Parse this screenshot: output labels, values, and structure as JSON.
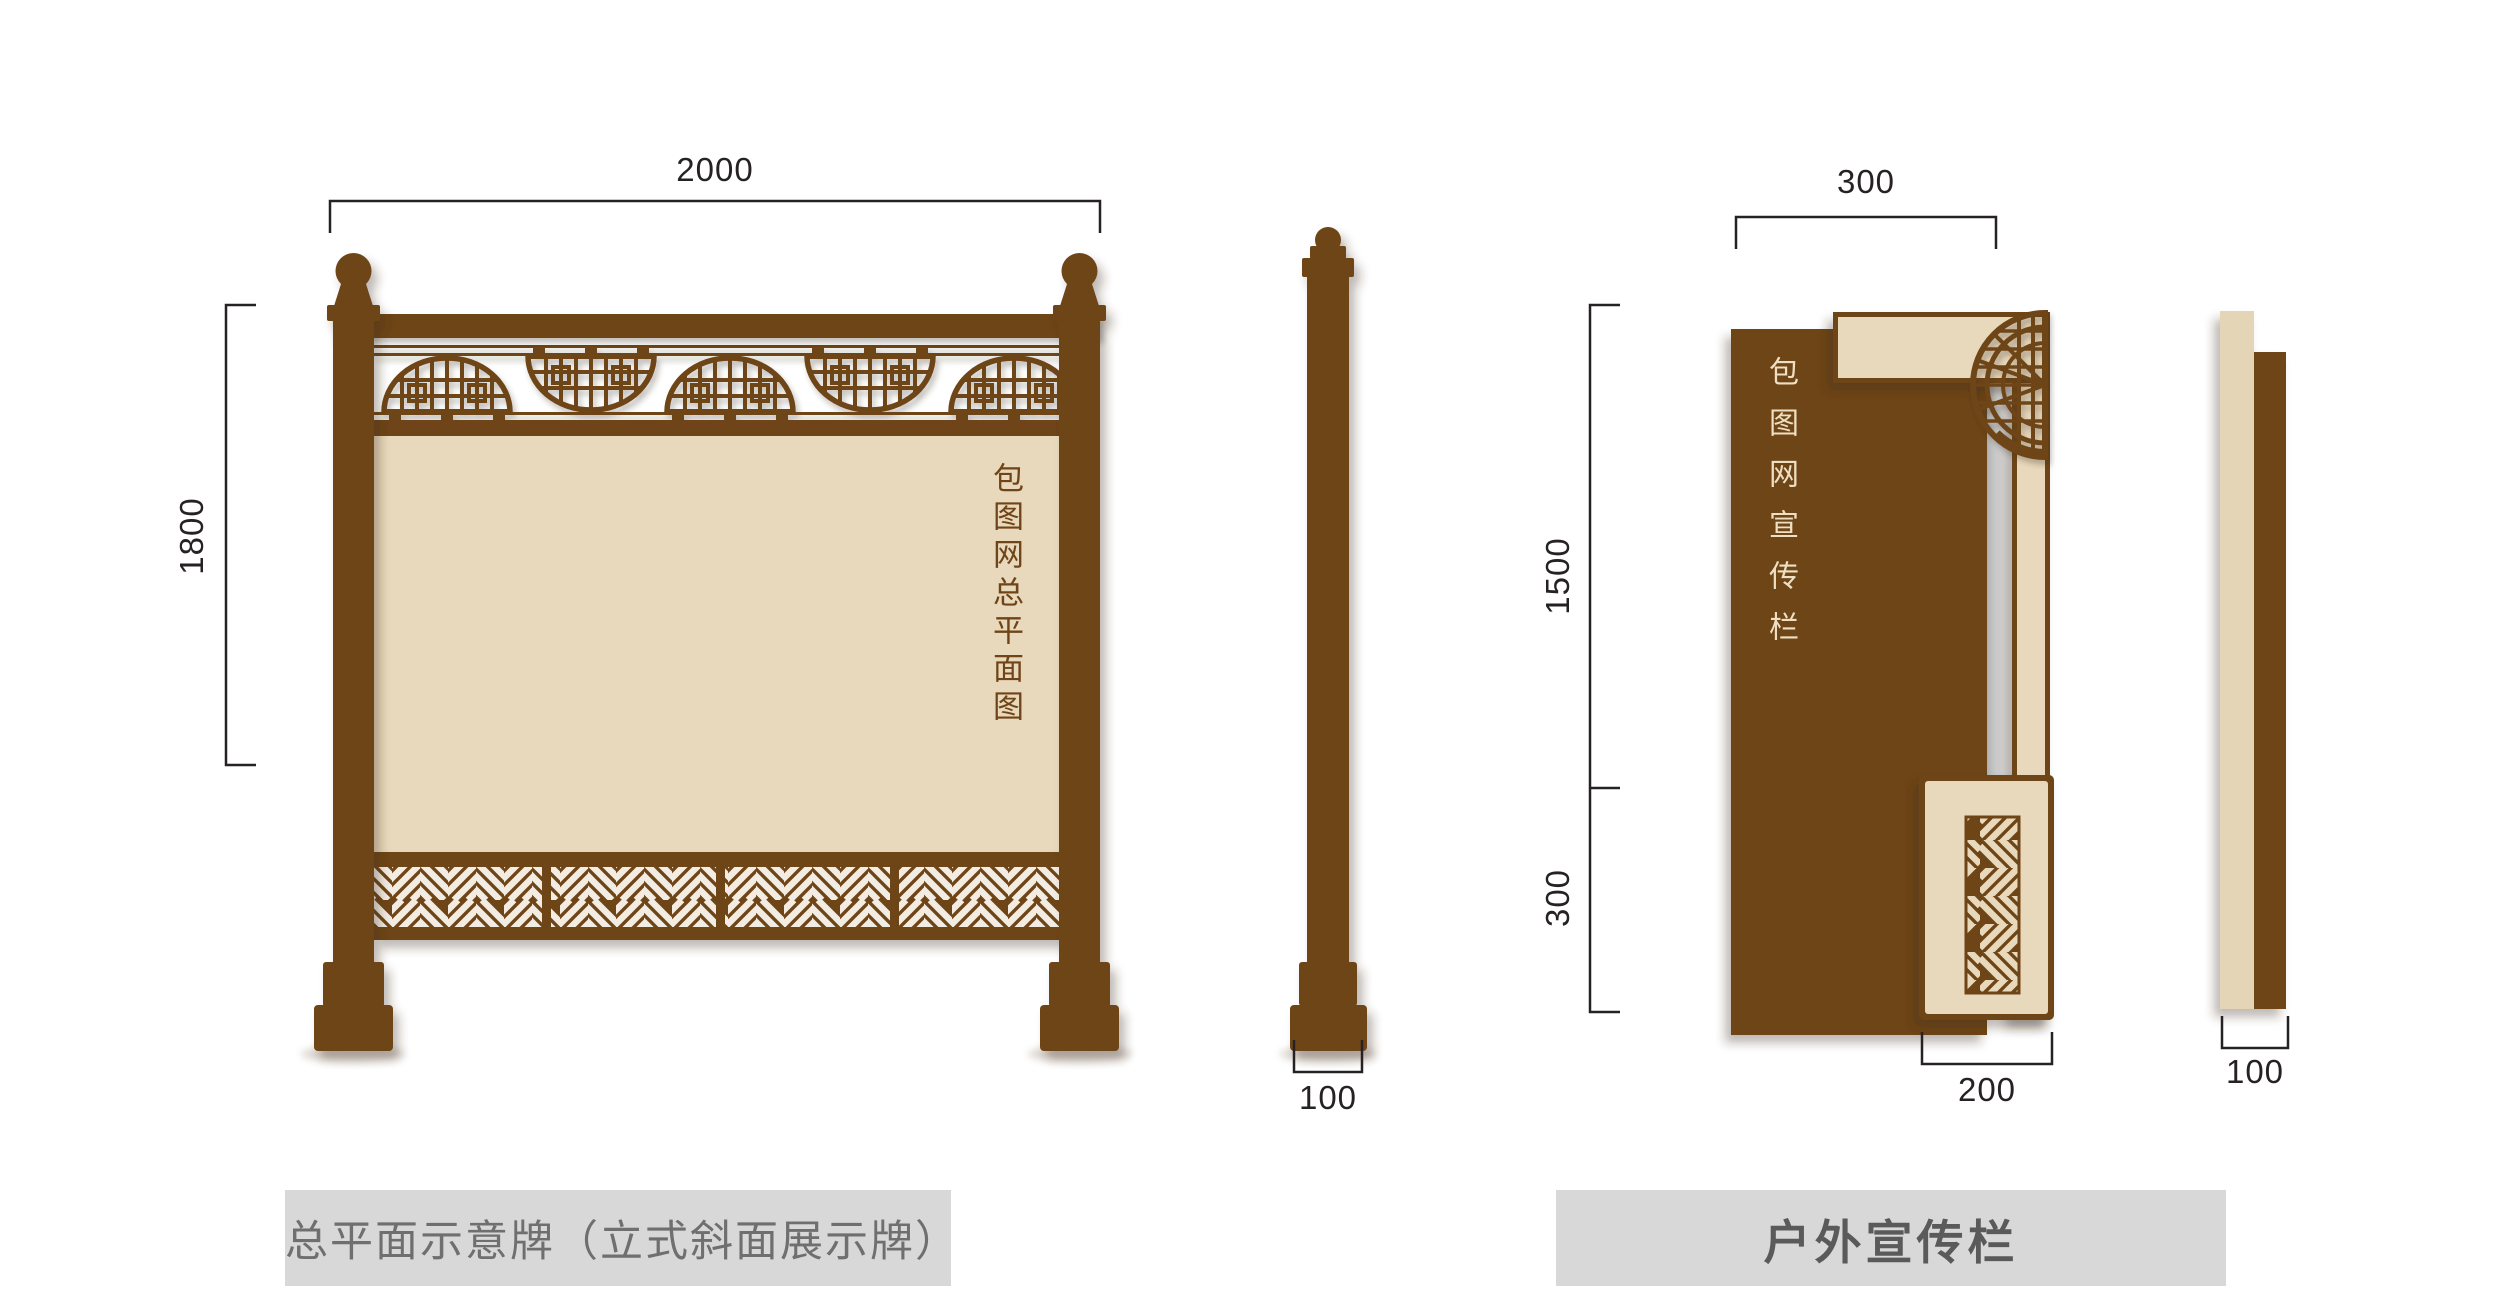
{
  "colors": {
    "brown": "#6e4418",
    "beige": "#e9d9bc",
    "beige_side": "#e5d5b7",
    "slit_white": "#f2ece2",
    "dim": "#262223",
    "board_text_brown": "#6e4418",
    "board_text_beige": "#eedfc2",
    "caption_bg": "#d8d8d8",
    "caption_text": "#6f6f6f",
    "caption_text_bold": "#5a5a5a",
    "gap_shadow": "#a8a8a8"
  },
  "left_figure": {
    "caption": "总平面示意牌（立式斜面展示牌）",
    "board_text": "包图网总平面图",
    "dim_width": "2000",
    "dim_height": "1800",
    "dim_side": "100"
  },
  "right_figure": {
    "caption": "户外宣传栏",
    "board_text": "包图网宣传栏",
    "dim_top": "300",
    "dim_upper": "1500",
    "dim_lower": "300",
    "dim_box": "200",
    "dim_side": "100"
  }
}
